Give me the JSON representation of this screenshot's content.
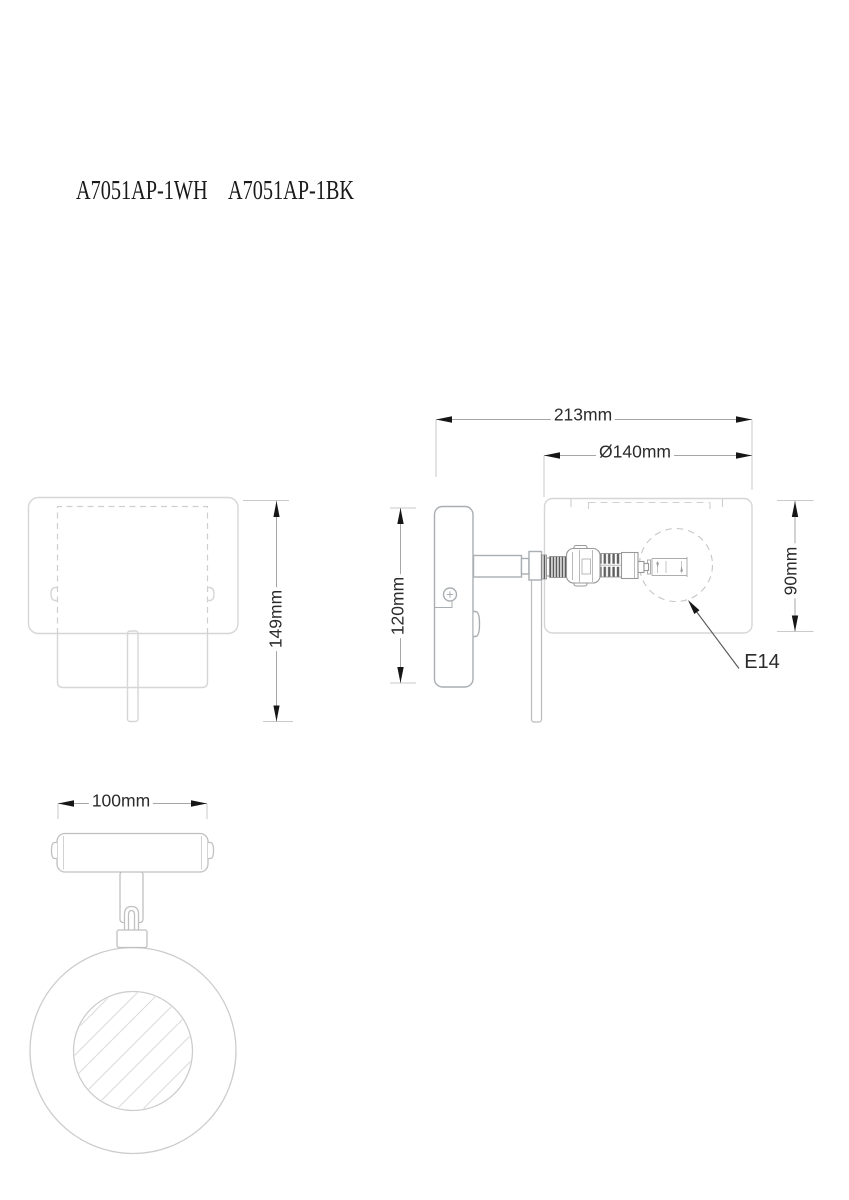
{
  "product": {
    "models": {
      "white": "A7051AP-1WH",
      "black": "A7051AP-1BK"
    }
  },
  "front_view": {
    "height_label": "149mm"
  },
  "side_view": {
    "depth_label": "213mm",
    "shade_diameter_label": "Ø140mm",
    "plate_height_label": "120mm",
    "shade_height_label": "90mm",
    "socket_type_label": "E14"
  },
  "bottom_view": {
    "plate_width_label": "100mm"
  },
  "colors": {
    "background": "#ffffff",
    "dimension_line": "#a6a6a6",
    "extension_line": "#cacaca",
    "arrow": "#161616",
    "dimension_text": "#2b2b2b",
    "shade_outline": "#d6d6d6",
    "hardware_outline": "#a9aeb2",
    "socket_detail": "#5a5a5a"
  }
}
